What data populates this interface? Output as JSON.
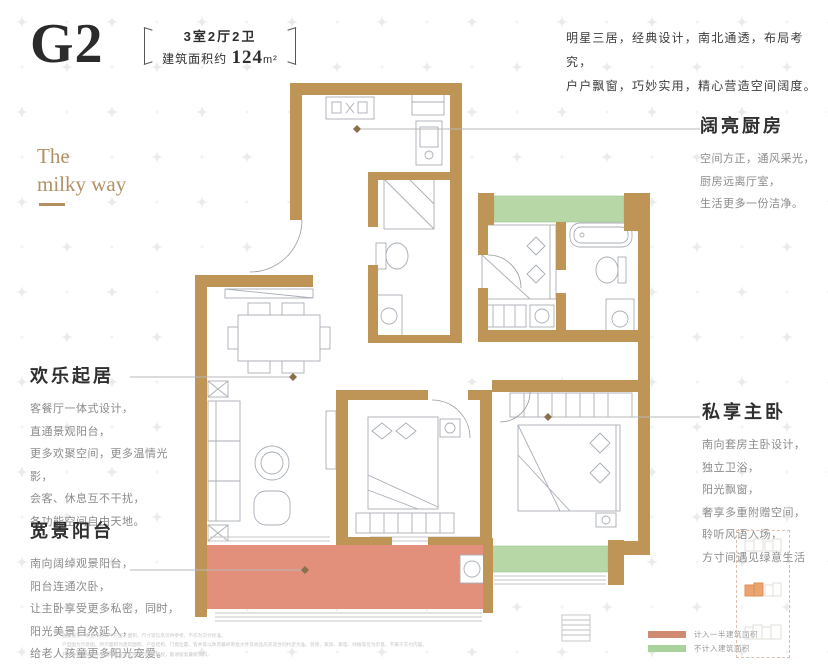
{
  "header": {
    "plan_code": "G2",
    "layout_spec": "3室2厅2卫",
    "area_prefix": "建筑面积约 ",
    "area_value": "124",
    "area_unit": "m²",
    "tagline_line1": "明星三居，经典设计，南北通透，布局考究，",
    "tagline_line2": "户户飘窗，巧妙实用，精心营造空间阔度。"
  },
  "brand": {
    "line1": "The",
    "line2": "milky way"
  },
  "sections": {
    "living": {
      "title": "欢乐起居",
      "lines": [
        "客餐厅一体式设计，",
        "直通景观阳台，",
        "更多欢聚空间，更多温情光影，",
        "会客、休息互不干扰，",
        "各功能空间自由天地。"
      ]
    },
    "balcony": {
      "title": "宽景阳台",
      "lines": [
        "南向阔绰观景阳台，",
        "阳台连通次卧，",
        "让主卧享受更多私密，同时，",
        "阳光美景自然延入，",
        "给老人孩童更多阳光宠爱。"
      ]
    },
    "kitchen": {
      "title": "阔亮厨房",
      "lines": [
        "空间方正，通风采光，",
        "厨房远离厅室，",
        "生活更多一份洁净。"
      ]
    },
    "master": {
      "title": "私享主卧",
      "lines": [
        "南向套房主卧设计，",
        "独立卫浴，",
        "阳光飘窗，",
        "奢享多重附赠空间，",
        "聆听风语入场，",
        "方寸间遇见绿意生活"
      ]
    }
  },
  "legend": {
    "items": [
      {
        "color": "#cf8a72",
        "label": "计入一半建筑面积"
      },
      {
        "color": "#a9d29c",
        "label": "不计入建筑面积"
      }
    ]
  },
  "disclaimer_lines": [
    "温馨提示：本宣传资料中户型、面积、尺寸等信息仅供参考，不作为交付标准。",
    "户型图为示意图，所示面积为建筑面积，户型结构、门窗位置、管井等以政府最终审批文件及商品房买卖合同约定为准。装修、家具、家电、绿植等仅为示意，不属于交付内容。",
    "开发商在法律允许范围内保留对宣传资料的解释权，敬请留意最新资料。"
  ],
  "colors": {
    "wall": "#bf9457",
    "bay_window_green": "#b7d8a6",
    "balcony_red": "#e28f7c",
    "brand_gold": "#b29064"
  }
}
